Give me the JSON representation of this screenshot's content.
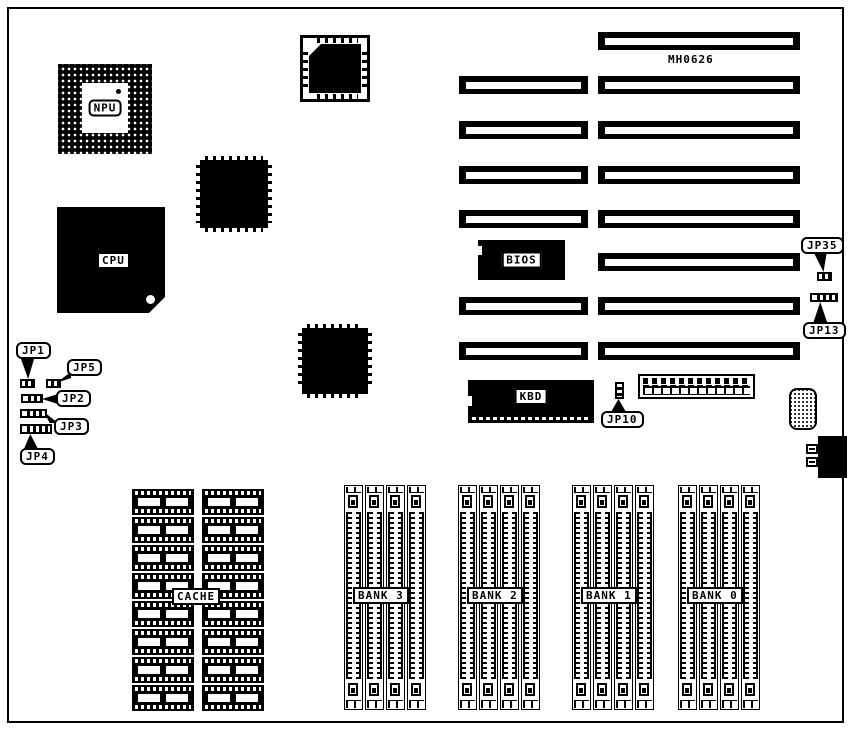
{
  "board": {
    "model": "MH0626"
  },
  "components": {
    "npu": {
      "label": "NPU"
    },
    "cpu": {
      "label": "CPU"
    },
    "bios": {
      "label": "BIOS"
    },
    "kbd": {
      "label": "KBD"
    },
    "cache": {
      "label": "CACHE"
    }
  },
  "jumpers": {
    "jp1": {
      "label": "JP1"
    },
    "jp2": {
      "label": "JP2"
    },
    "jp3": {
      "label": "JP3"
    },
    "jp4": {
      "label": "JP4"
    },
    "jp5": {
      "label": "JP5"
    },
    "jp10": {
      "label": "JP10"
    },
    "jp13": {
      "label": "JP13"
    },
    "jp35": {
      "label": "JP35"
    }
  },
  "memory_banks": {
    "labels": [
      "BANK 3",
      "BANK 2",
      "BANK 1",
      "BANK 0"
    ],
    "sockets_per_bank": 4
  },
  "cache_chips": {
    "columns": 2,
    "rows": 8
  },
  "expansion_slots": {
    "total": 8,
    "with_left_segment": 6,
    "right_segments": 8
  },
  "colors": {
    "ink": "#000000",
    "paper": "#ffffff"
  }
}
